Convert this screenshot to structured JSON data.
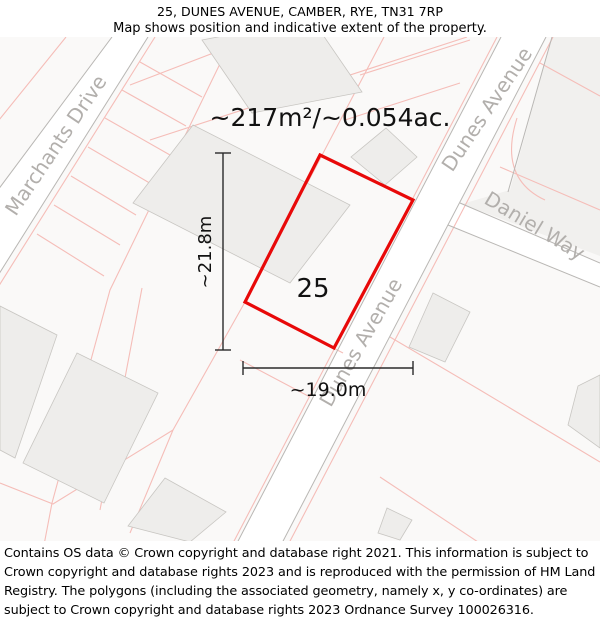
{
  "header": {
    "title": "25, DUNES AVENUE, CAMBER, RYE, TN31 7RP",
    "subtitle": "Map shows position and indicative extent of the property."
  },
  "map": {
    "area_label": "~217m²/~0.054ac.",
    "property_number": "25",
    "width_label": "~19.0m",
    "height_label": "~21.8m",
    "streets": {
      "marchants": "Marchants Drive",
      "dunes_upper": "Dunes Avenue",
      "dunes_lower": "Dunes Avenue",
      "daniel": "Daniel Way"
    },
    "colors": {
      "property_outline": "#e80909",
      "parcel_line": "#f5bdb8",
      "road_border": "#b9b7b4",
      "street_label": "#b2afac",
      "building_fill": "#eeedeb",
      "building_stroke": "#c8c6c2",
      "block_fill": "#f1f0ee",
      "measurement": "#2a2a2a",
      "background": "#faf9f8"
    }
  },
  "footer": {
    "copyright": "Contains OS data © Crown copyright and database right 2021. This information is subject to Crown copyright and database rights 2023 and is reproduced with the permission of HM Land Registry. The polygons (including the associated geometry, namely x, y co-ordinates) are subject to Crown copyright and database rights 2023 Ordnance Survey 100026316."
  }
}
